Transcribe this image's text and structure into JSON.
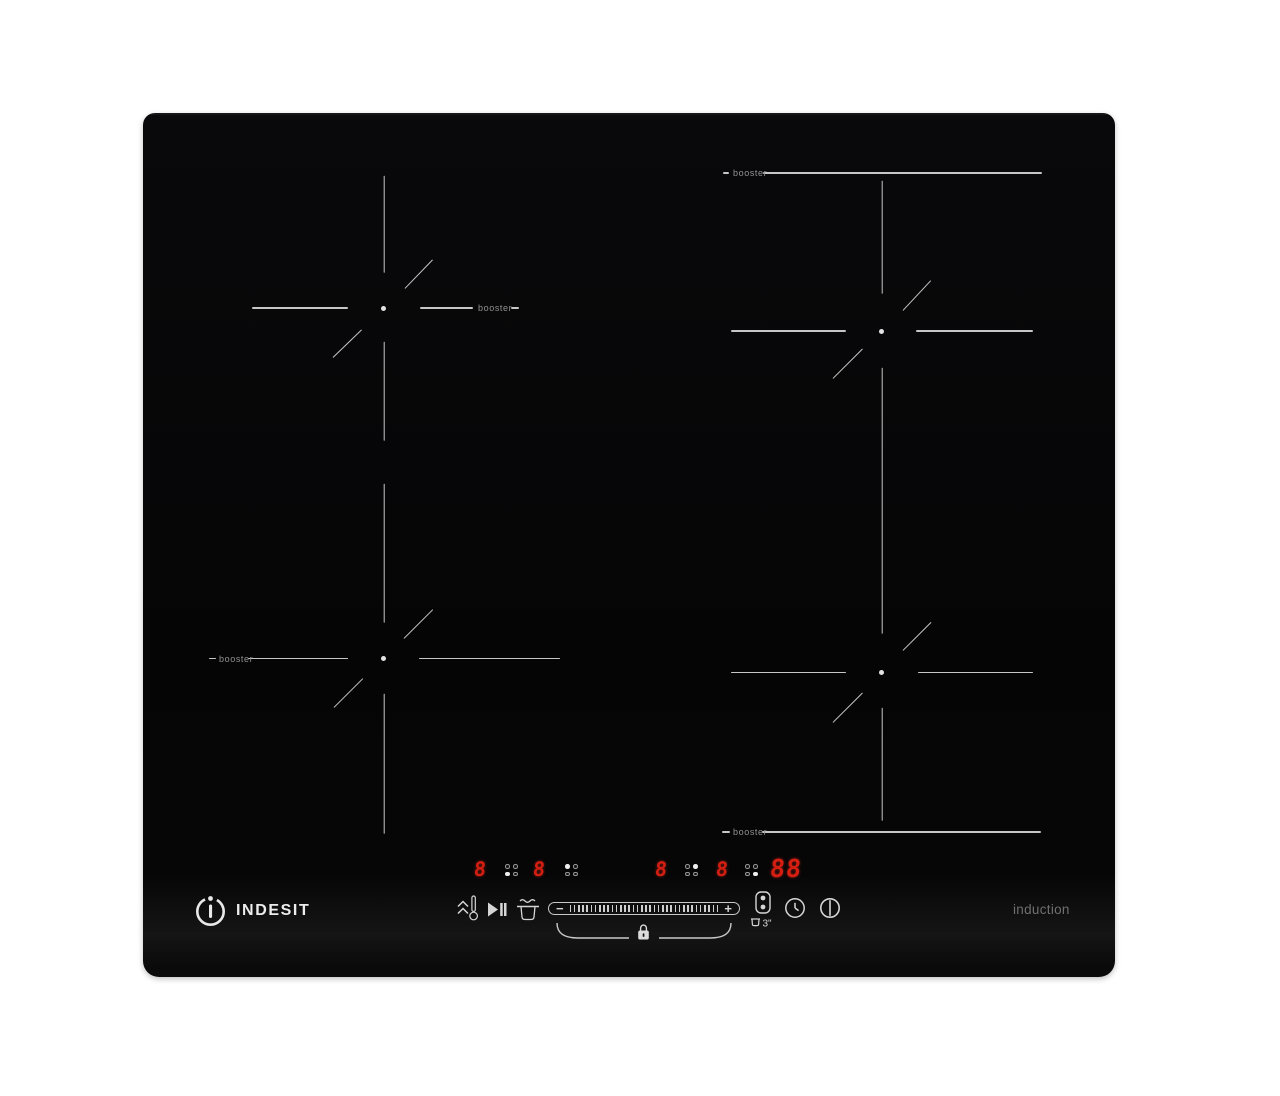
{
  "page": {
    "background": "#ffffff"
  },
  "brand": {
    "wordmark": "INDESIT",
    "tagline": "induction"
  },
  "hob": {
    "surface_color": "#060607",
    "line_color": "#c6c6c6",
    "booster_text_color": "#929292",
    "led_color": "#d41e12"
  },
  "zones": [
    {
      "name": "rear-left",
      "dot": [
        240.5,
        195
      ],
      "segments": [
        [
          240.5,
          63,
          240.5,
          160
        ],
        [
          240.5,
          229,
          240.5,
          328
        ],
        [
          109,
          195,
          205,
          195
        ],
        [
          277,
          195,
          330,
          195
        ],
        [
          368,
          195,
          376,
          195
        ],
        [
          262,
          176,
          290,
          147
        ],
        [
          190,
          245,
          219,
          217
        ]
      ],
      "booster": {
        "label": "booster",
        "x": 335,
        "y": 195
      }
    },
    {
      "name": "front-left",
      "dot": [
        240.5,
        545.5
      ],
      "segments": [
        [
          240.5,
          371,
          240.5,
          510
        ],
        [
          240.5,
          581,
          240.5,
          721
        ],
        [
          66,
          545.5,
          73,
          545.5
        ],
        [
          105,
          545.5,
          205,
          545.5
        ],
        [
          276,
          545.5,
          417,
          545.5
        ],
        [
          261,
          526,
          290,
          497
        ],
        [
          191,
          595,
          220,
          566
        ]
      ],
      "booster": {
        "label": "booster",
        "x": 76,
        "y": 545.5
      }
    },
    {
      "name": "rear-right",
      "dot": [
        738.5,
        218
      ],
      "segments": [
        [
          580,
          60,
          586,
          60
        ],
        [
          620,
          60,
          899,
          60
        ],
        [
          738.5,
          68,
          738.5,
          181
        ],
        [
          738.5,
          255,
          738.5,
          521
        ],
        [
          588,
          218,
          703,
          218
        ],
        [
          773,
          218,
          890,
          218
        ],
        [
          760,
          198,
          788,
          168
        ],
        [
          690,
          266,
          720,
          236
        ]
      ],
      "booster": {
        "label": "booster",
        "x": 590,
        "y": 60
      }
    },
    {
      "name": "front-right",
      "dot": [
        738.5,
        559.5
      ],
      "segments": [
        [
          588,
          559.5,
          703,
          559.5
        ],
        [
          775,
          559.5,
          890,
          559.5
        ],
        [
          738.5,
          595,
          738.5,
          708
        ],
        [
          760,
          538,
          788,
          510
        ],
        [
          690,
          610,
          720,
          580
        ],
        [
          579,
          719,
          587,
          719
        ],
        [
          619,
          719,
          898,
          719
        ]
      ],
      "booster": {
        "label": "booster",
        "x": 590,
        "y": 719
      }
    }
  ],
  "display": {
    "timer_value": "88",
    "groups": [
      {
        "value": "8",
        "position_dot": "bottom-left",
        "x": 331,
        "dots_x": 362
      },
      {
        "value": "8",
        "position_dot": "top-left",
        "x": 390,
        "dots_x": 422
      },
      {
        "value": "8",
        "position_dot": "top-right",
        "x": 512,
        "dots_x": 542
      },
      {
        "value": "8",
        "position_dot": "bottom-right",
        "x": 573,
        "dots_x": 602
      }
    ]
  },
  "controls": {
    "minus_label": "−",
    "plus_label": "+",
    "tick_count": 36,
    "flexi_delay_label": "3\"",
    "icons": [
      "heat-level-icon",
      "play-pause-icon",
      "melt-icon",
      "power-slider",
      "child-lock-icon",
      "bridge-zones-icon",
      "timer-clock-icon",
      "power-icon"
    ]
  }
}
